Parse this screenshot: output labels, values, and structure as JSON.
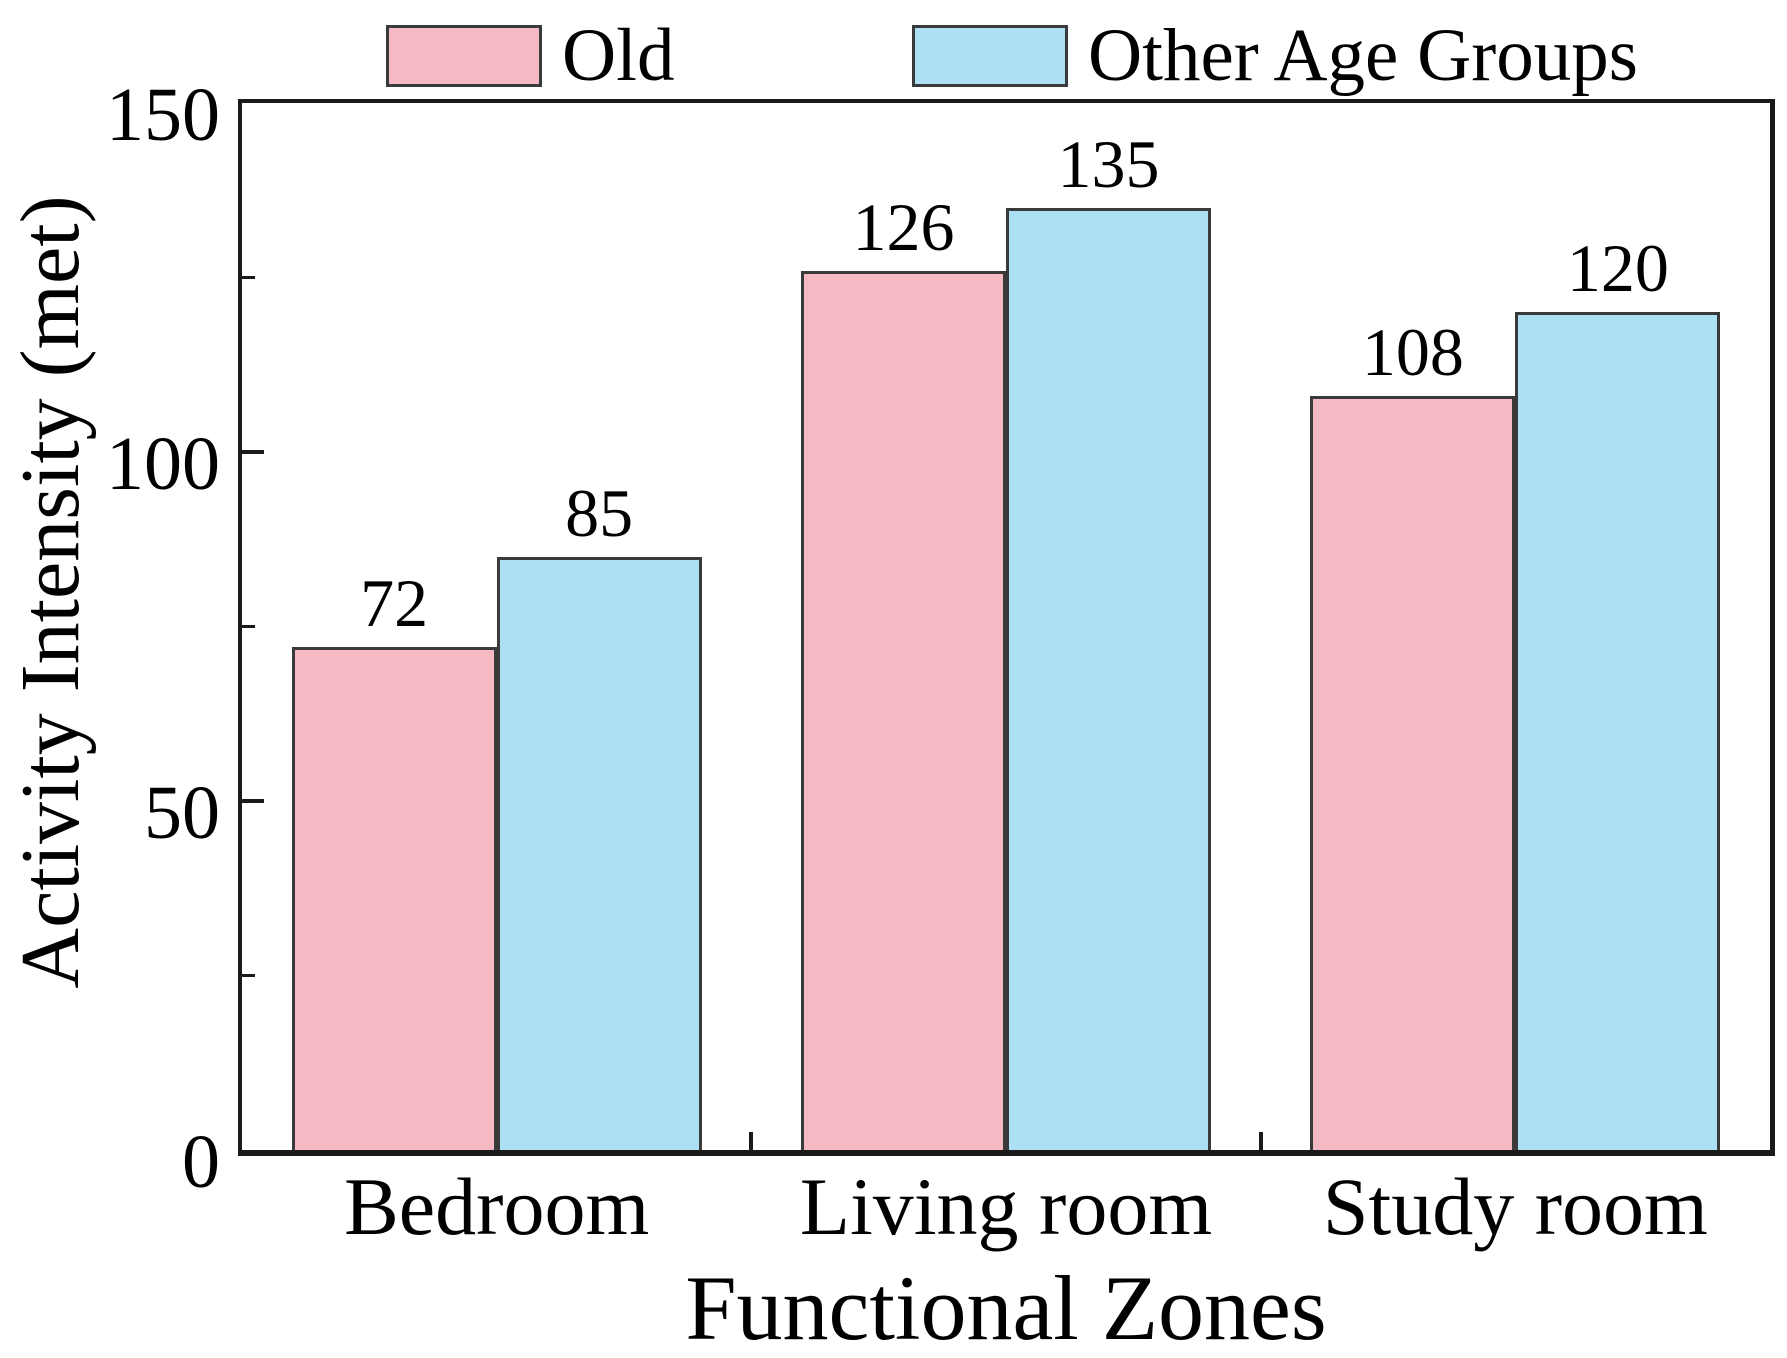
{
  "chart_data": {
    "type": "bar",
    "title": "",
    "categories": [
      "Bedroom",
      "Living room",
      "Study room"
    ],
    "series": [
      {
        "name": "Old",
        "color": "#F4B9C3",
        "values": [
          72,
          126,
          108
        ]
      },
      {
        "name": "Other Age Groups",
        "color": "#AEE0F5",
        "values": [
          85,
          135,
          120
        ]
      }
    ],
    "value_labels": [
      [
        72,
        126,
        108
      ],
      [
        85,
        135,
        120
      ]
    ],
    "xlabel": "Functional Zones",
    "ylabel": "Activity Intensity (met)",
    "ylim": [
      0,
      150
    ],
    "yticks": [
      0,
      50,
      100,
      150
    ],
    "ytick_labels": [
      "0",
      "50",
      "100",
      "150"
    ],
    "yminorticks": [
      25,
      75,
      125
    ],
    "grid": false,
    "legend_position": "top",
    "bar_edge_color": "#3a3a3a",
    "axis_color": "#1a1a1a"
  }
}
